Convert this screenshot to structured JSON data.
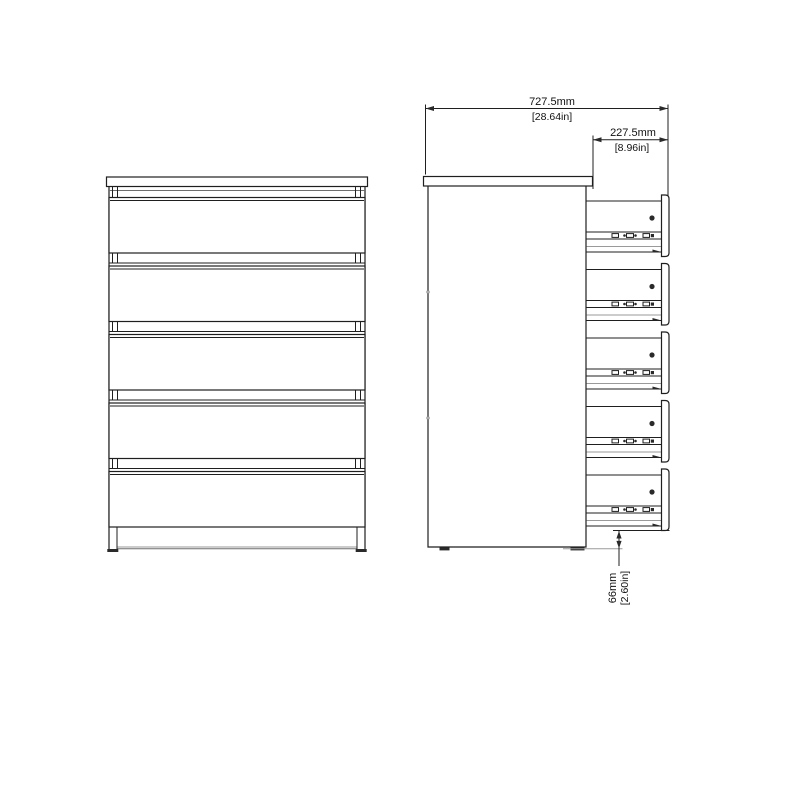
{
  "canvas": {
    "background": "#ffffff",
    "line_color": "#1f1f1f",
    "light_line_color": "#9a9a9a",
    "text_color": "#111111"
  },
  "drawing": {
    "views": {
      "front": {
        "drawer_count": 5
      },
      "side": {
        "drawer_count": 5
      }
    },
    "dimensions": {
      "total_depth": {
        "metric": "727.5mm",
        "imperial": "[28.64in]"
      },
      "drawer_extension": {
        "metric": "227.5mm",
        "imperial": "[8.96in]"
      },
      "floor_clearance": {
        "metric": "66mm",
        "imperial": "[2.60in]"
      }
    }
  }
}
